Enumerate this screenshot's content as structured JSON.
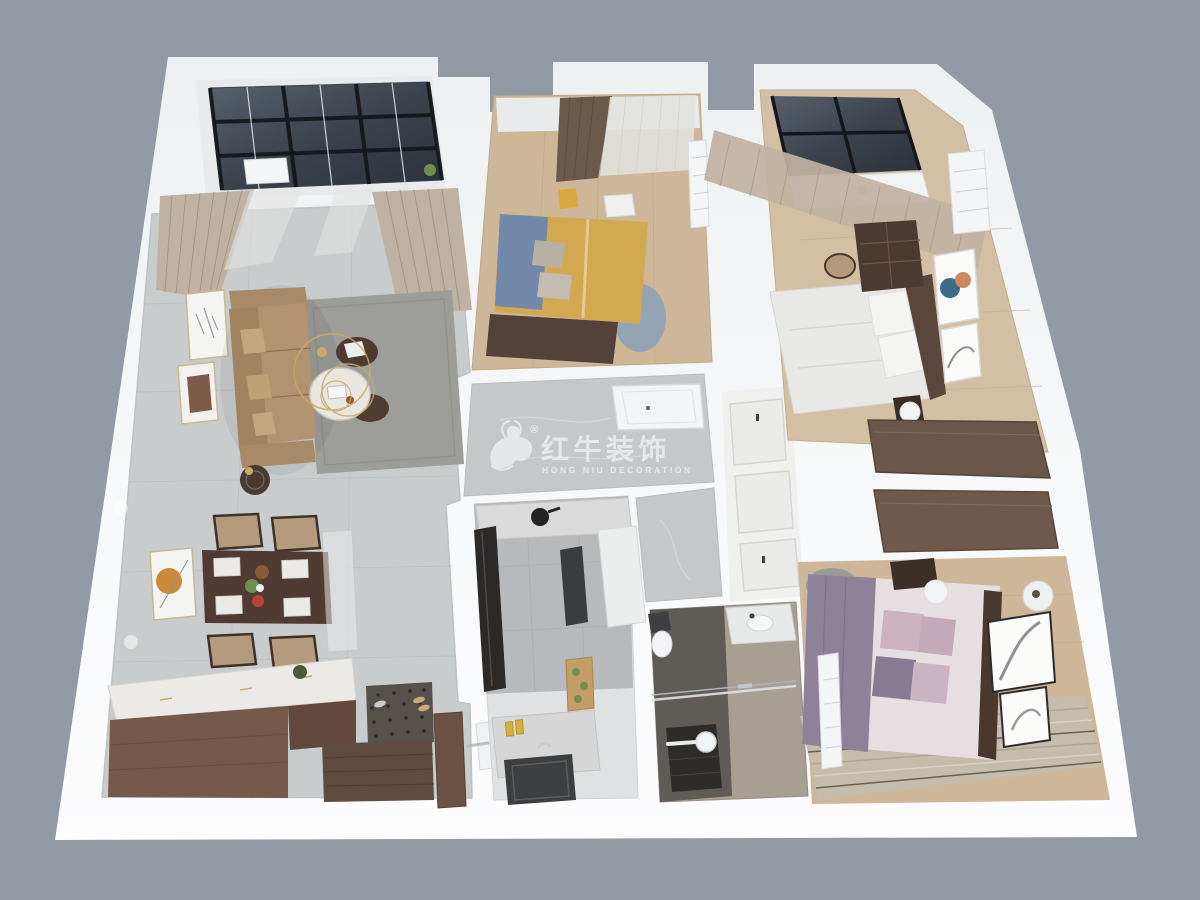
{
  "scene": {
    "title": "3D apartment floor plan render",
    "background": "#939aa4"
  },
  "watermark": {
    "registered_mark": "®",
    "brand_cn": "红牛装饰",
    "brand_en": "HONG NIU DECORATION",
    "text_color": "#ffffff"
  },
  "palette": {
    "background": "#939aa4",
    "platform_white": "#f6f8f9",
    "tile_living": "#c9cccd",
    "tile_kitchen": "#b7b9ba",
    "marble_corridor": "#c5c7c9",
    "marble_kitchen_lower": "#dfe1e2",
    "wood_floor": "#cdb798",
    "wood_cabinet": "#75594a",
    "wood_dark": "#4f3b31",
    "sofa_tan": "#b2926f",
    "rug_gray": "#9d9e9a",
    "rug_beige": "#c6bcab",
    "curtain_beige": "#c0b2a2",
    "curtain_dark": "#6b5a4c",
    "sheer": "#e2e3e1",
    "glass_dark": "#3c434d",
    "bed1_yellow": "#d2a851",
    "bed1_blue": "#7389ac",
    "bed2_white": "#e8e8e6",
    "bed3_purple": "#8d8298",
    "bed3_sheet": "#e7dee2",
    "pillow_pink": "#ccb2bf",
    "bath_dark": "#5f5b56",
    "bath_beige": "#a89f93",
    "gold": "#c9a96a",
    "ac_white": "#f3f5f6"
  }
}
